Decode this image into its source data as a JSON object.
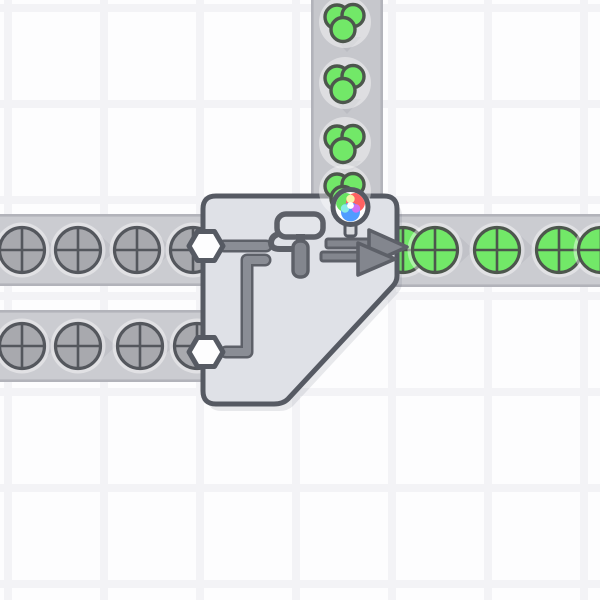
{
  "scene": {
    "name": "factory-grid-view",
    "grid": {
      "cell_size": 96,
      "line_offset": 4,
      "line_width": 8
    }
  },
  "colors": {
    "background": "#fdfdfe",
    "grid_line": "#f3f3f6",
    "belt_fill_h": "#cbccd1",
    "belt_fill_v": "#c6c7cc",
    "belt_edge": "#b2b3ba",
    "belt_chevron": "#b9bac1",
    "item_halo": "rgba(255,255,255,0.42)",
    "shape_gray_fill": "#a8a9ae",
    "shape_gray_outline": "#54575d",
    "shape_green_fill": "#72e868",
    "shape_green_outline": "#4d564d",
    "building_fill": "#dfe1e7",
    "building_outline": "#565a63",
    "building_shadow": "rgba(85,90,105,0.13)",
    "pipe_dark": "#5d6068",
    "pipe_light": "#8a8d95",
    "icon_fill": "#83868e",
    "icon_dark": "#5d6068",
    "roller_head_fill": "#e3e5ea",
    "hexagon_fill": "#fdfdfe",
    "wheel_outline": "#565a63",
    "wheel_white": "#ffffff",
    "wheel_red": "#ff6262",
    "wheel_green": "#68e163",
    "wheel_blue": "#4f9cff",
    "wheel_cyan": "#87ece5",
    "wheel_magenta": "#cf70f2",
    "wheel_yellow": "#f7f4a8",
    "wheel_stem": "#d9dbdf"
  },
  "belts": [
    {
      "name": "belt-color-input-vertical",
      "direction": "down",
      "x": 311,
      "y": 0,
      "width": 72,
      "height": 198,
      "chevrons": [
        {
          "x": 347,
          "y": 44
        },
        {
          "x": 347,
          "y": 106
        },
        {
          "x": 347,
          "y": 168
        }
      ],
      "items": [
        {
          "type": "color-green",
          "x": 345,
          "y": 22
        },
        {
          "type": "color-green",
          "x": 345,
          "y": 83
        },
        {
          "type": "color-green",
          "x": 345,
          "y": 143
        }
      ]
    },
    {
      "name": "belt-shapes-top-left",
      "direction": "right",
      "x": 0,
      "y": 214,
      "width": 208,
      "height": 72,
      "chevrons": [
        {
          "x": 50,
          "y": 250
        },
        {
          "x": 108,
          "y": 250
        },
        {
          "x": 166,
          "y": 250
        }
      ],
      "items": [
        {
          "type": "shape-circle-gray",
          "x": 22,
          "y": 250
        },
        {
          "type": "shape-circle-gray",
          "x": 78,
          "y": 250
        },
        {
          "type": "shape-circle-gray",
          "x": 137,
          "y": 250
        },
        {
          "type": "shape-circle-gray",
          "x": 193,
          "y": 250
        }
      ]
    },
    {
      "name": "belt-shapes-bottom-left",
      "direction": "right",
      "x": 0,
      "y": 310,
      "width": 208,
      "height": 72,
      "chevrons": [
        {
          "x": 50,
          "y": 346
        },
        {
          "x": 108,
          "y": 346
        },
        {
          "x": 166,
          "y": 346
        }
      ],
      "items": [
        {
          "type": "shape-circle-gray",
          "x": 22,
          "y": 346
        },
        {
          "type": "shape-circle-gray",
          "x": 78,
          "y": 346
        },
        {
          "type": "shape-circle-gray",
          "x": 140,
          "y": 346
        },
        {
          "type": "shape-circle-gray",
          "x": 197,
          "y": 346
        }
      ]
    },
    {
      "name": "belt-output-right",
      "direction": "right",
      "x": 396,
      "y": 214,
      "width": 204,
      "height": 73,
      "chevrons": [
        {
          "x": 466,
          "y": 250
        },
        {
          "x": 528,
          "y": 250
        }
      ],
      "items": [
        {
          "type": "shape-circle-green",
          "x": 403,
          "y": 250
        },
        {
          "type": "shape-circle-green",
          "x": 435,
          "y": 250
        },
        {
          "type": "shape-circle-green",
          "x": 497,
          "y": 250
        },
        {
          "type": "shape-circle-green",
          "x": 559,
          "y": 250
        },
        {
          "type": "shape-circle-green",
          "x": 601,
          "y": 250
        }
      ]
    }
  ],
  "building": {
    "name": "double-painter",
    "x": 203,
    "y": 196,
    "right": 397,
    "bottom": 404,
    "corner_radius": 13,
    "diagonal": {
      "from_y": 282,
      "to_x": 283
    },
    "inputs": [
      {
        "x": 206,
        "y": 246
      },
      {
        "x": 206,
        "y": 352
      }
    ],
    "pipes": {
      "top": {
        "x1": 224,
        "y": 246,
        "x2": 266
      },
      "bottom_path": [
        [
          226,
          352
        ],
        [
          247,
          352
        ],
        [
          247,
          260
        ],
        [
          265,
          260
        ]
      ]
    },
    "roller": {
      "head": [
        277,
        214,
        46,
        23
      ],
      "neck": [
        296,
        234,
        9,
        10
      ],
      "grip": [
        293,
        241,
        15,
        36
      ]
    },
    "arrows": {
      "back": {
        "shaft": [
          326,
          239,
          44,
          9
        ],
        "head": [
          [
            369,
            230
          ],
          [
            407,
            247
          ],
          [
            369,
            264
          ]
        ]
      },
      "front": {
        "shaft": [
          321,
          252,
          40,
          9
        ],
        "head": [
          [
            358,
            243
          ],
          [
            395,
            259
          ],
          [
            358,
            275
          ]
        ]
      }
    },
    "queued_color_item": {
      "type": "color-green",
      "x": 345,
      "y": 191
    },
    "color_wheel": {
      "x": 350.5,
      "y": 207,
      "radius": 17.5,
      "stem": [
        345,
        220,
        11,
        16
      ]
    },
    "icons": [
      "paint-roller-icon",
      "color-wheel-icon",
      "double-arrow-icon",
      "hexagon-input-icon"
    ]
  }
}
